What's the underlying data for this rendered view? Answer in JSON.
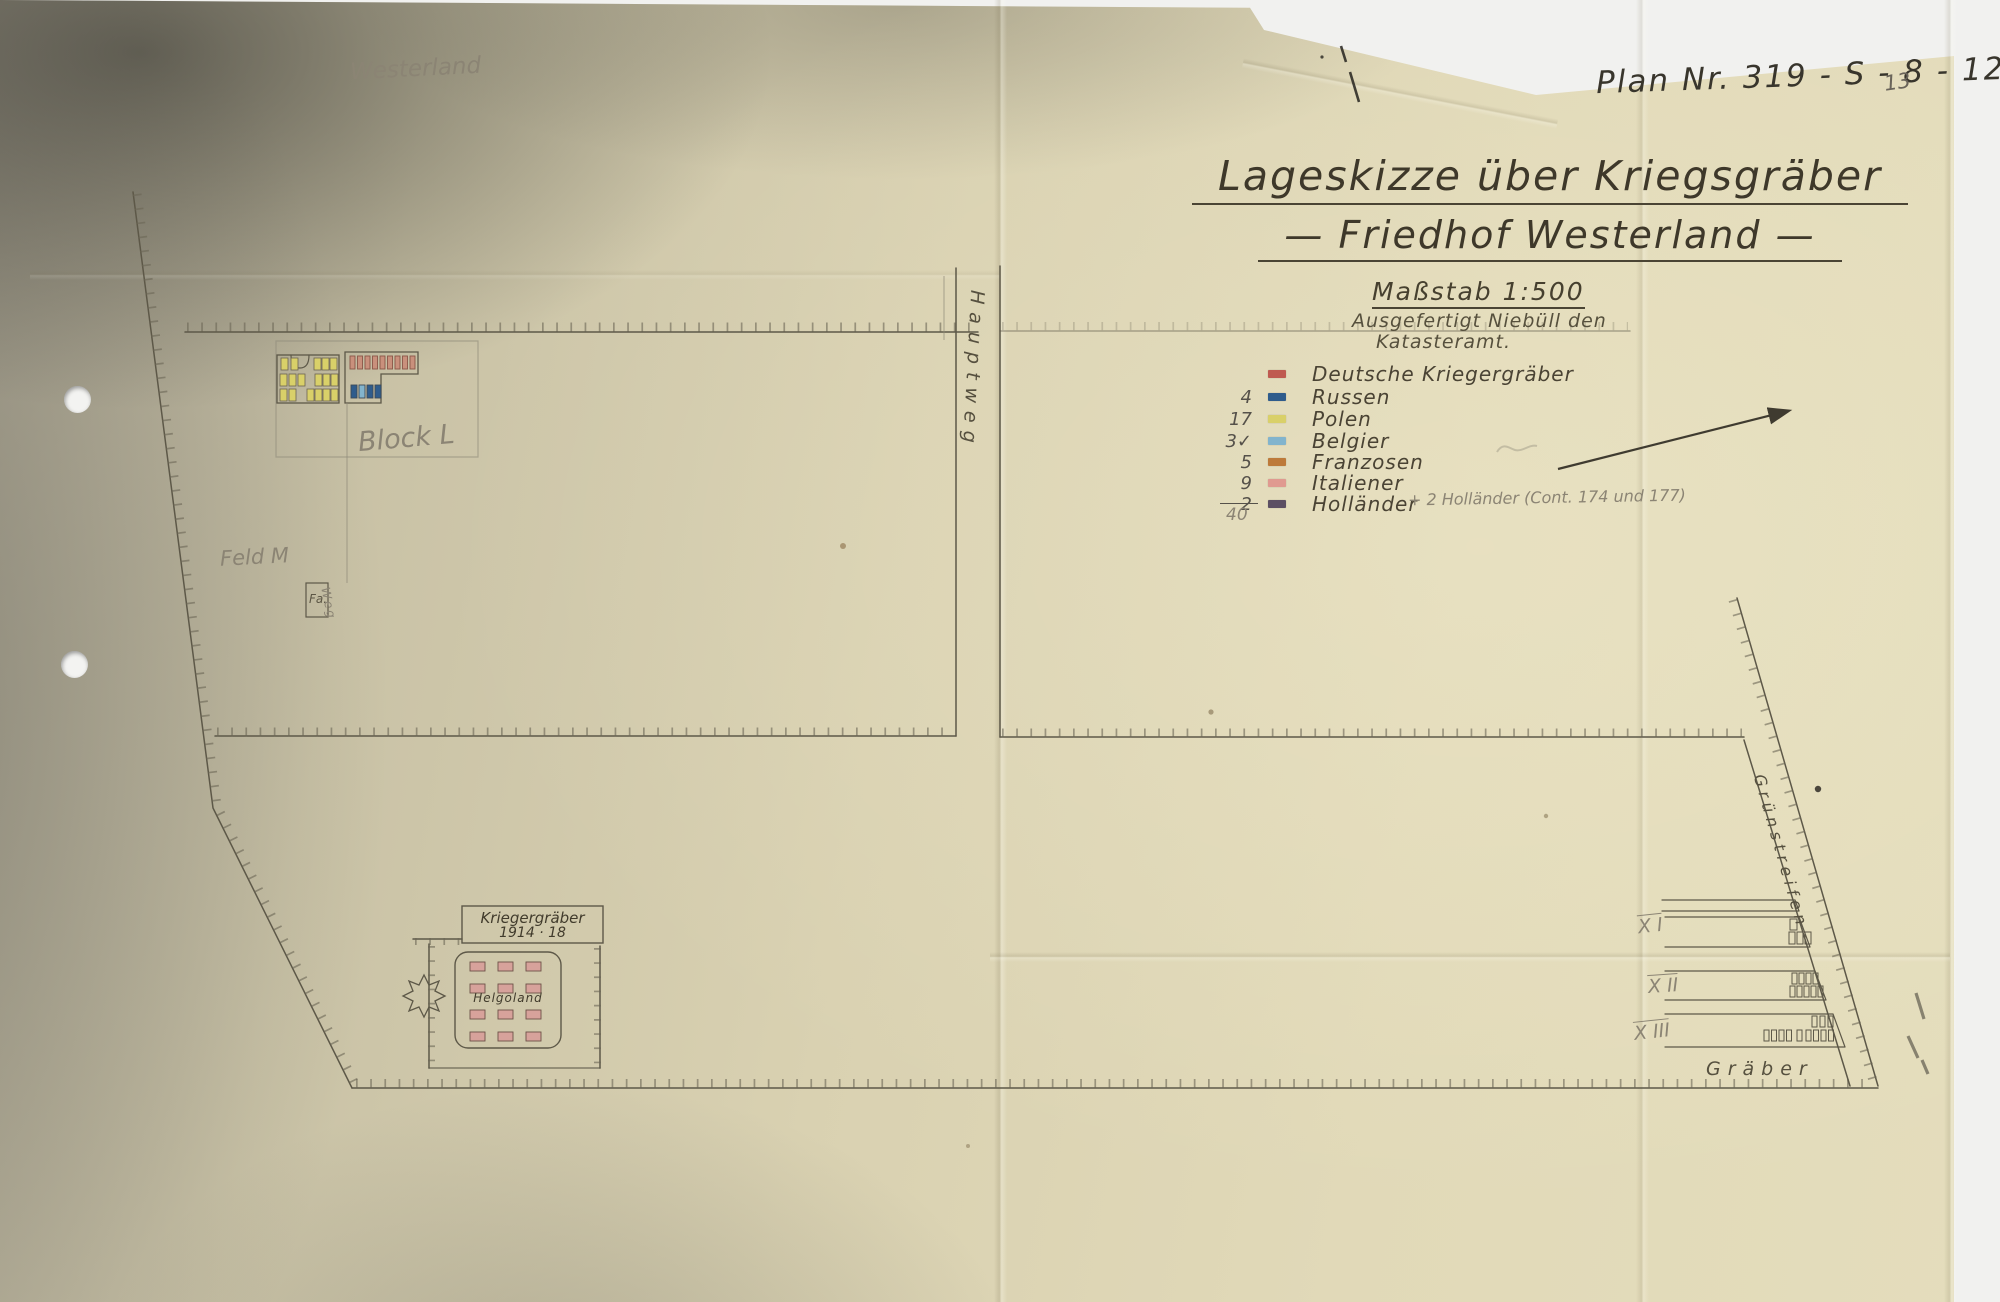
{
  "header": {
    "pencil_note": "Westerland",
    "plan_number": "Plan Nr. 319 - S - 8 - 12",
    "page_number": "13"
  },
  "title_block": {
    "title_line1": "Lageskizze über Kriegsgräber",
    "title_line2": "— Friedhof Westerland —",
    "scale": "Maßstab 1:500",
    "issued_line1": "Ausgefertigt Niebüll den",
    "issued_line2": "Katasteramt."
  },
  "legend": {
    "items": [
      {
        "count": "",
        "label": "Deutsche Kriegergräber",
        "color": "#bf5a50"
      },
      {
        "count": "4",
        "label": "Russen",
        "color": "#2f5c8c"
      },
      {
        "count": "17",
        "label": "Polen",
        "color": "#d9d069"
      },
      {
        "count": "3✓",
        "label": "Belgier",
        "color": "#82b4cd"
      },
      {
        "count": "5",
        "label": "Franzosen",
        "color": "#bd7a3a"
      },
      {
        "count": "9",
        "label": "Italiener",
        "color": "#e09a90"
      },
      {
        "count": "2",
        "label": "Holländer",
        "color": "#5c4f63"
      }
    ],
    "hollaender_annotation": "+ 2 Holländer (Cont. 174 und 177)",
    "total": "40"
  },
  "map_labels": {
    "hauptweg": "Hauptweg",
    "block_l": "Block L",
    "feld_m": "Feld M",
    "fa_box": "Fa.",
    "weg": "Weg",
    "banner_line1": "Kriegergräber",
    "banner_line2": "1914 · 18",
    "helgoland": "Helgoland",
    "gruenstreifen": "Grünstreifen",
    "row_x1": "X I",
    "row_x2": "X II",
    "row_x3": "X III",
    "graeber": "Gräber"
  }
}
